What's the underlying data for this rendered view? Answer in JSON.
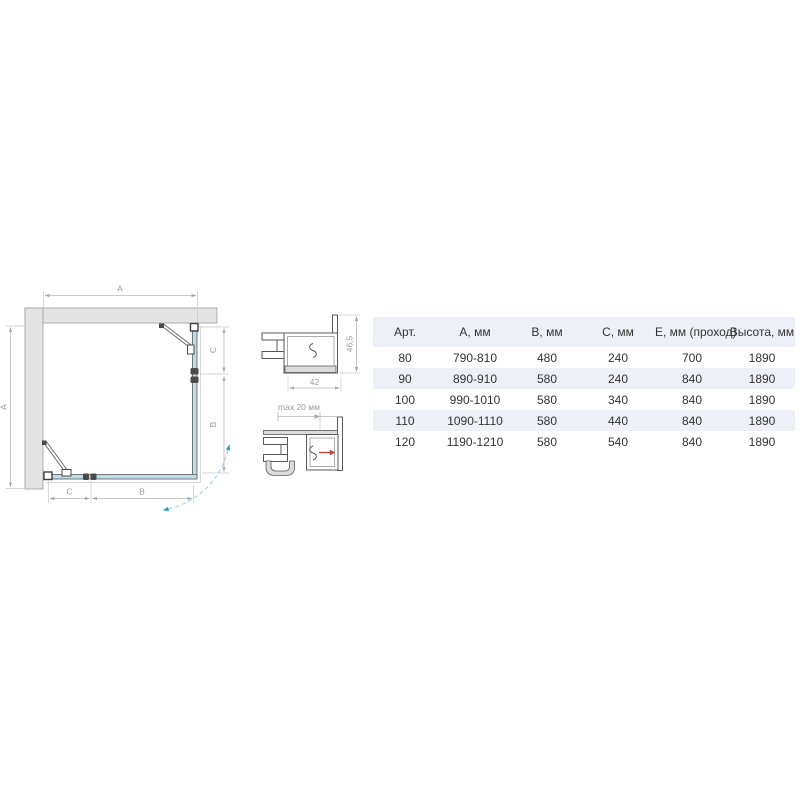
{
  "plan": {
    "dim_top": "A",
    "dim_left": "A",
    "dim_right_upper": "C",
    "dim_right_lower": "B",
    "dim_bottom_left": "C",
    "dim_bottom_right": "B"
  },
  "profile_top": {
    "dim_width": "42",
    "dim_height": "46,5"
  },
  "profile_bottom": {
    "dim_adjust": "max 20 мм"
  },
  "table": {
    "headers": [
      "Арт.",
      "А, мм",
      "В, мм",
      "С, мм",
      "Е, мм (проход)",
      "Высота, мм"
    ],
    "rows": [
      [
        "80",
        "790-810",
        "480",
        "240",
        "700",
        "1890"
      ],
      [
        "90",
        "890-910",
        "580",
        "240",
        "840",
        "1890"
      ],
      [
        "100",
        "990-1010",
        "580",
        "340",
        "840",
        "1890"
      ],
      [
        "110",
        "1090-1110",
        "580",
        "440",
        "840",
        "1890"
      ],
      [
        "120",
        "1190-1210",
        "580",
        "540",
        "840",
        "1890"
      ]
    ]
  },
  "colors": {
    "wall_fill": "#e4e4e4",
    "glass_blue": "#bcdcea",
    "swing_arc_blue": "#a6d7e7",
    "arc_arrow_blue": "#2f97c0",
    "adjust_arrow_red": "#c43c35",
    "table_stripe": "#eef0f8",
    "line_dark": "#5a5a5a",
    "dim_gray": "#b5b5b5"
  }
}
